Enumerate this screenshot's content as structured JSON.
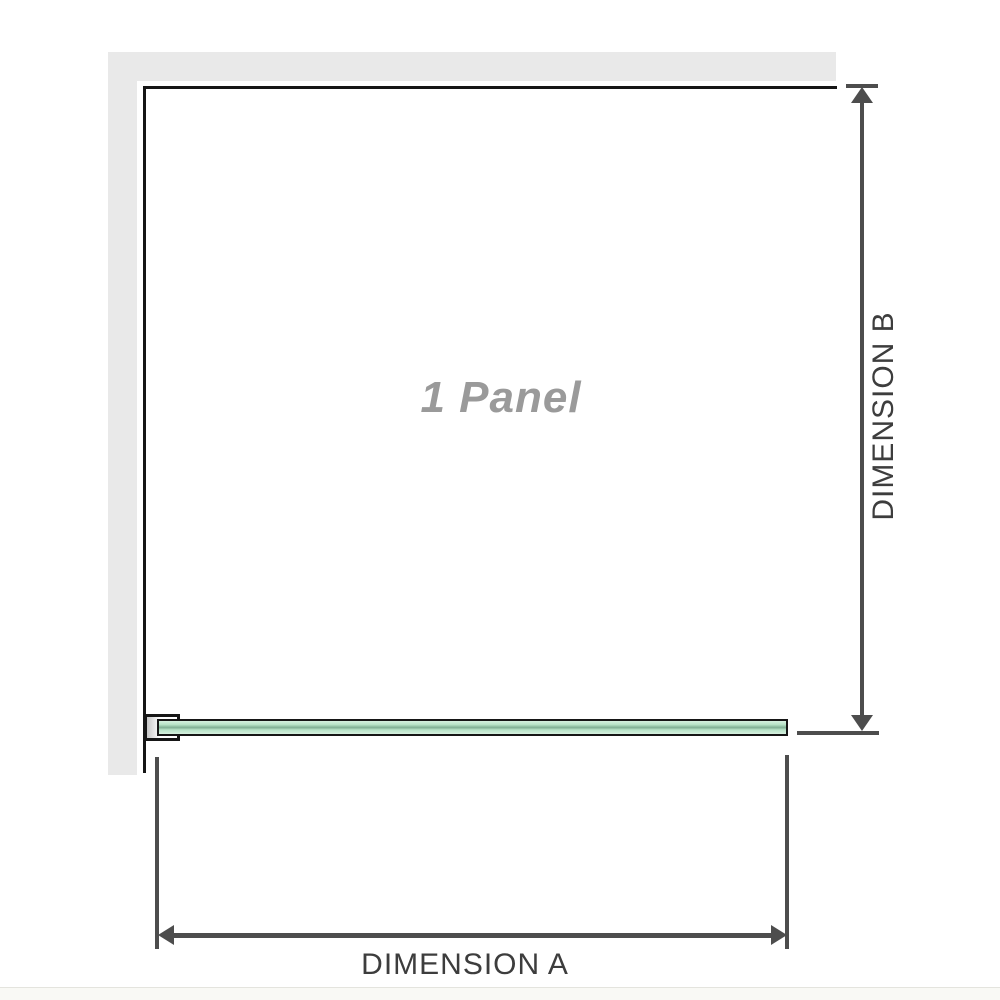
{
  "diagram": {
    "title_hint": "Shower screen single panel dimension diagram",
    "panel_label": "1 Panel",
    "dimension_a_label": "DIMENSION A",
    "dimension_b_label": "DIMENSION B"
  },
  "theme": {
    "wall_color": "#e9e9e9",
    "outline_color": "#161616",
    "dim_color": "#4d4d4d",
    "label_color": "#3d3d3d",
    "panel_label_color": "#9a9a9a",
    "glass_light": "#d6f0df",
    "glass_fill": "#b7e3c7",
    "glass_dark": "#7fae93",
    "footer_strip": "#f9f9f5",
    "footer_line": "#e4e4de"
  }
}
